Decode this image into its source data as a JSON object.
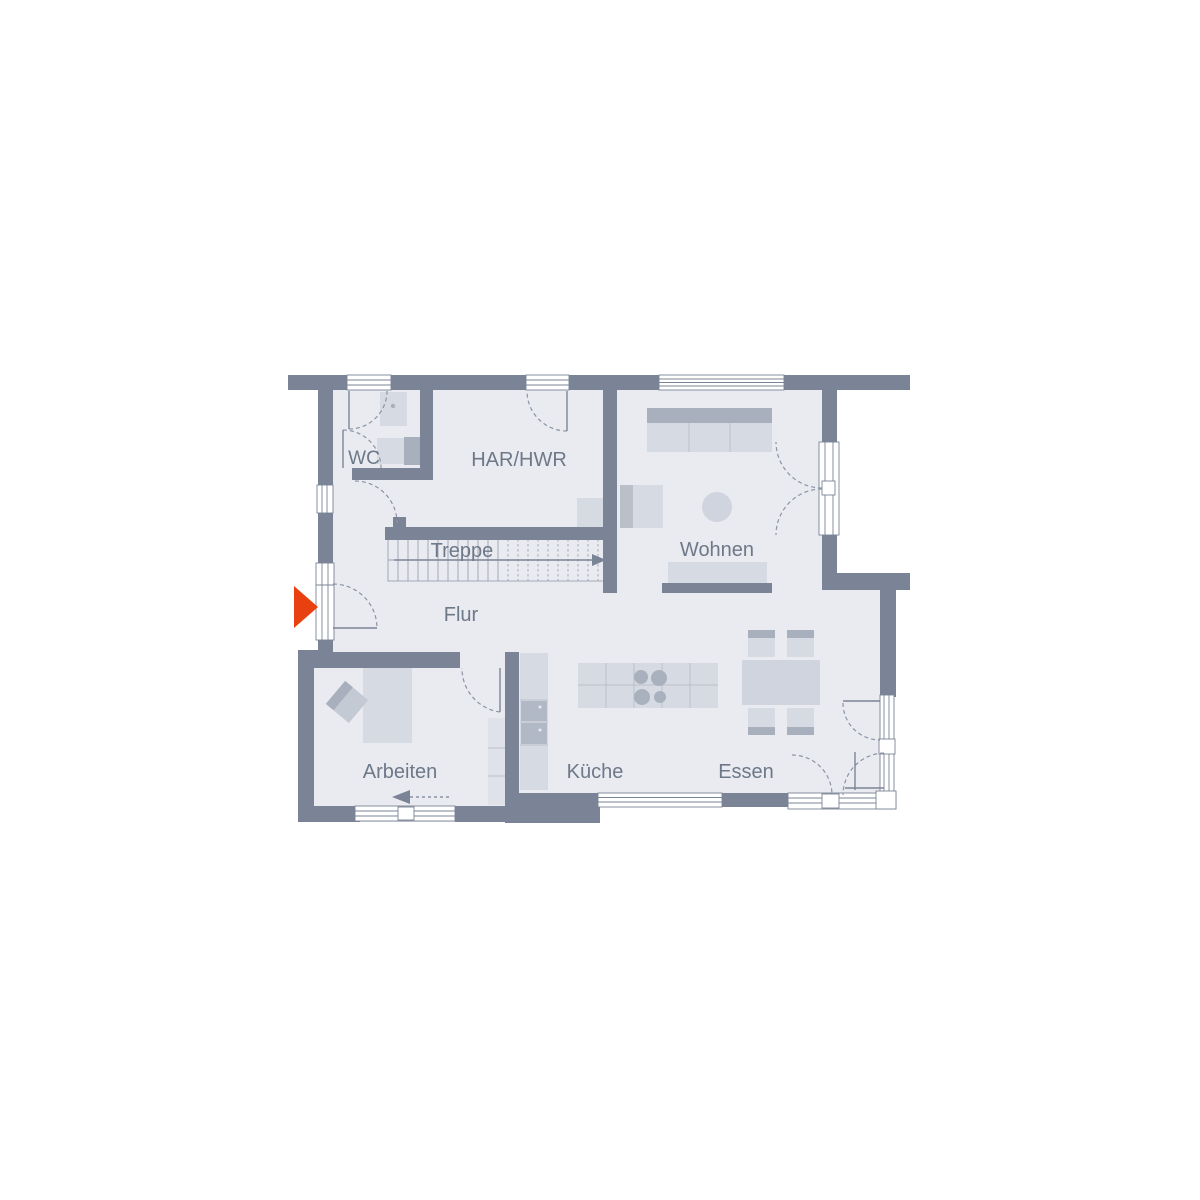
{
  "floorplan": {
    "rooms": {
      "wc": {
        "label": "WC"
      },
      "har_hwr": {
        "label": "HAR/HWR"
      },
      "treppe": {
        "label": "Treppe"
      },
      "wohnen": {
        "label": "Wohnen"
      },
      "flur": {
        "label": "Flur"
      },
      "arbeiten": {
        "label": "Arbeiten"
      },
      "kueche": {
        "label": "Küche"
      },
      "essen": {
        "label": "Essen"
      }
    },
    "colors": {
      "wall": "#7b8496",
      "floor": "#e9ebf0",
      "furniture_light": "#d6dae2",
      "furniture_mid": "#cfd4de",
      "furniture_dark": "#a9b0bd",
      "thin_line": "#8b94a5",
      "label_text": "#6d7889",
      "entrance_arrow": "#e8400f",
      "background": "#ffffff"
    }
  }
}
